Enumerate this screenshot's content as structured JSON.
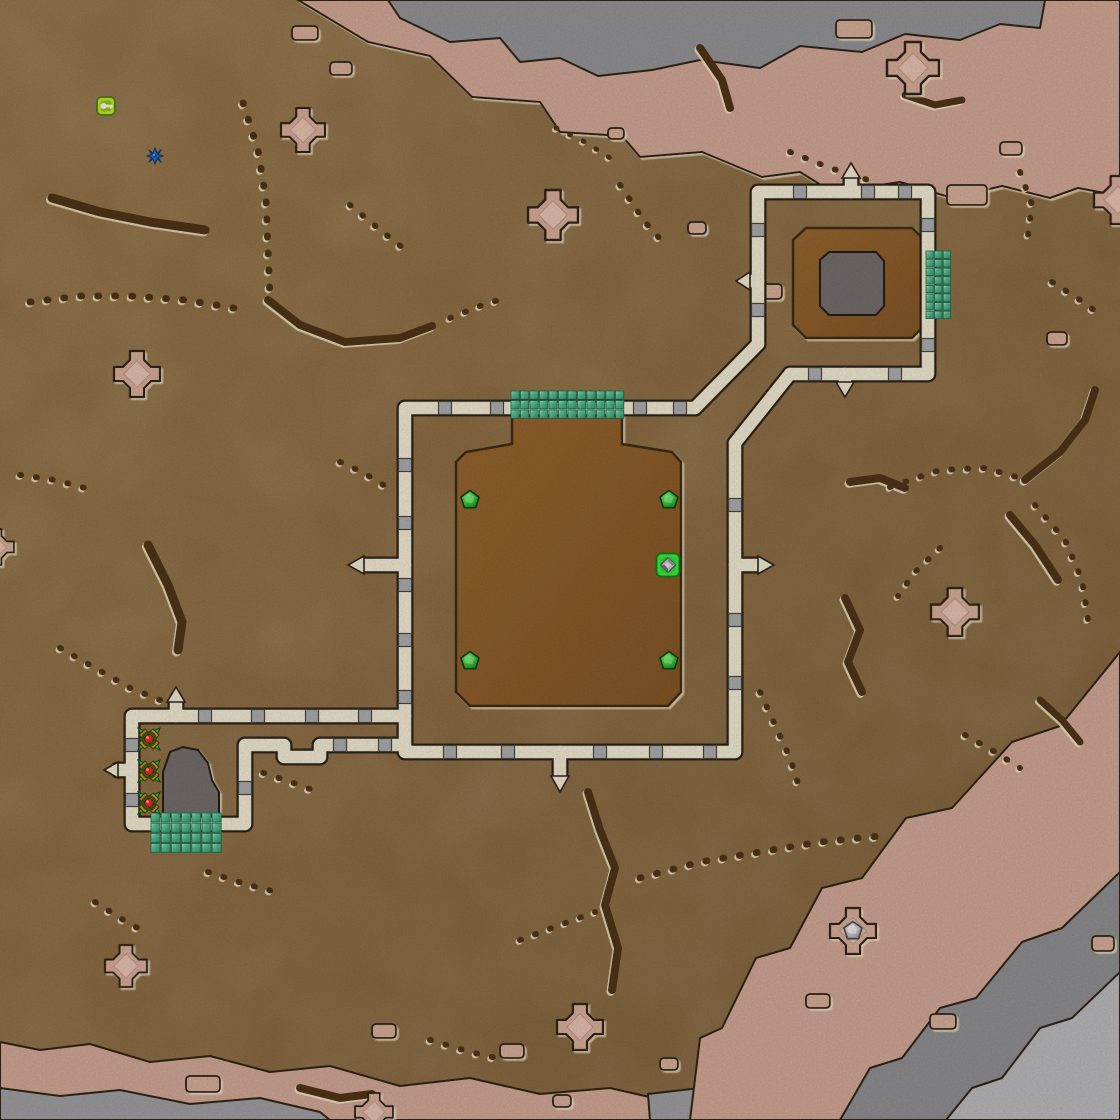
{
  "map": {
    "width": 1120,
    "height": 1120,
    "palette": {
      "terrain": "#8e6d44",
      "terrain_dark": "#7c5f3a",
      "inner_dirt": "#8a5a29",
      "wall": "#e8e1cb",
      "wall_outline": "#2b2215",
      "post_gray": "#a7a7ab",
      "beach_pink": "#cba291",
      "rock_gray": "#8f8f92",
      "rock_gray_light": "#b4b4b6",
      "mound_gray": "#6f6b67",
      "gate_teal": "#4fb78e",
      "marker_green": "#2fb32f",
      "selected_green": "#39e639",
      "crack_brown": "#4e3213",
      "red_dot": "#d32b1f",
      "blue_burst": "#2f72c8",
      "key_icon_green": "#b8e02c"
    },
    "objects": {
      "key_item": {
        "x": 106,
        "y": 106
      },
      "blue_burst": {
        "x": 155,
        "y": 156
      },
      "green_pentagons": [
        [
          470,
          500
        ],
        [
          669,
          500
        ],
        [
          470,
          661
        ],
        [
          669,
          661
        ]
      ],
      "selected_unit": {
        "x": 668,
        "y": 565
      },
      "x_markers": [
        [
          149,
          739
        ],
        [
          149,
          771
        ],
        [
          149,
          803
        ]
      ]
    },
    "gates": [
      {
        "id": "central-top-gate",
        "x": 511,
        "y": 391,
        "cols": 12,
        "rows": 3,
        "s": 9.5
      },
      {
        "id": "outpost-right-gate",
        "x": 926,
        "y": 251,
        "cols": 3,
        "rows": 8,
        "s": 8.6
      },
      {
        "id": "pen-bottom-gate",
        "x": 151,
        "y": 813,
        "cols": 7,
        "rows": 4,
        "s": 10.2
      }
    ],
    "crosses": [
      {
        "cx": 303,
        "cy": 130,
        "s": 44
      },
      {
        "cx": 553,
        "cy": 215,
        "s": 50
      },
      {
        "cx": 913,
        "cy": 68,
        "s": 52
      },
      {
        "cx": 1118,
        "cy": 200,
        "s": 48
      },
      {
        "cx": 137,
        "cy": 374,
        "s": 46
      },
      {
        "cx": 955,
        "cy": 612,
        "s": 48
      },
      {
        "cx": -4,
        "cy": 547,
        "s": 36
      },
      {
        "cx": 126,
        "cy": 966,
        "s": 42
      },
      {
        "cx": 580,
        "cy": 1027,
        "s": 46
      },
      {
        "cx": 374,
        "cy": 1112,
        "s": 38
      },
      {
        "cx": 853,
        "cy": 931,
        "s": 46,
        "pentagon": true
      }
    ],
    "pink_decals": [
      [
        292,
        26,
        26,
        14
      ],
      [
        330,
        62,
        22,
        13
      ],
      [
        836,
        20,
        36,
        18
      ],
      [
        947,
        185,
        40,
        20
      ],
      [
        1000,
        142,
        22,
        13
      ],
      [
        760,
        284,
        22,
        15
      ],
      [
        1047,
        332,
        20,
        13
      ],
      [
        688,
        222,
        18,
        12
      ],
      [
        608,
        128,
        16,
        11
      ],
      [
        186,
        1076,
        34,
        16
      ],
      [
        372,
        1024,
        24,
        14
      ],
      [
        500,
        1044,
        24,
        14
      ],
      [
        930,
        1014,
        26,
        15
      ],
      [
        806,
        994,
        24,
        14
      ],
      [
        1092,
        936,
        22,
        15
      ],
      [
        553,
        1095,
        18,
        12
      ],
      [
        660,
        1058,
        18,
        12
      ]
    ],
    "posts": [
      [
        445,
        408
      ],
      [
        497,
        408
      ],
      [
        640,
        408
      ],
      [
        680,
        408
      ],
      [
        405,
        465
      ],
      [
        405,
        523
      ],
      [
        405,
        585
      ],
      [
        405,
        640
      ],
      [
        405,
        697
      ],
      [
        450,
        752
      ],
      [
        508,
        752
      ],
      [
        600,
        752
      ],
      [
        656,
        752
      ],
      [
        710,
        752
      ],
      [
        735,
        505
      ],
      [
        735,
        620
      ],
      [
        735,
        683
      ],
      [
        205,
        716
      ],
      [
        258,
        716
      ],
      [
        312,
        716
      ],
      [
        365,
        716
      ],
      [
        340,
        745
      ],
      [
        385,
        745
      ],
      [
        132,
        745
      ],
      [
        132,
        800
      ],
      [
        245,
        788
      ],
      [
        800,
        192
      ],
      [
        868,
        192
      ],
      [
        905,
        192
      ],
      [
        758,
        230
      ],
      [
        758,
        310
      ],
      [
        928,
        225
      ],
      [
        928,
        345
      ],
      [
        815,
        374
      ],
      [
        895,
        374
      ]
    ],
    "cracks": [
      {
        "t": "dots",
        "w": 7,
        "p": [
          [
            30,
            302
          ],
          [
            80,
            296
          ],
          [
            130,
            296
          ],
          [
            185,
            300
          ],
          [
            245,
            310
          ]
        ]
      },
      {
        "t": "solid",
        "w": 9,
        "p": [
          [
            52,
            198
          ],
          [
            100,
            212
          ],
          [
            150,
            222
          ],
          [
            205,
            230
          ]
        ]
      },
      {
        "t": "dots",
        "w": 7,
        "p": [
          [
            243,
            103
          ],
          [
            258,
            150
          ],
          [
            266,
            200
          ],
          [
            268,
            250
          ],
          [
            270,
            298
          ]
        ]
      },
      {
        "t": "solid",
        "w": 8,
        "p": [
          [
            268,
            300
          ],
          [
            300,
            325
          ],
          [
            345,
            342
          ],
          [
            400,
            338
          ],
          [
            432,
            326
          ]
        ]
      },
      {
        "t": "dots",
        "w": 6,
        "p": [
          [
            450,
            318
          ],
          [
            480,
            306
          ],
          [
            505,
            298
          ]
        ]
      },
      {
        "t": "dots",
        "w": 6,
        "p": [
          [
            350,
            205
          ],
          [
            380,
            230
          ],
          [
            408,
            252
          ]
        ]
      },
      {
        "t": "solid",
        "w": 9,
        "p": [
          [
            148,
            545
          ],
          [
            168,
            585
          ],
          [
            182,
            622
          ],
          [
            178,
            650
          ]
        ]
      },
      {
        "t": "dots",
        "w": 6,
        "p": [
          [
            60,
            648
          ],
          [
            95,
            668
          ],
          [
            130,
            688
          ],
          [
            160,
            700
          ]
        ]
      },
      {
        "t": "dots",
        "w": 6,
        "p": [
          [
            20,
            475
          ],
          [
            55,
            480
          ],
          [
            85,
            488
          ]
        ]
      },
      {
        "t": "dots",
        "w": 6,
        "p": [
          [
            340,
            462
          ],
          [
            362,
            472
          ],
          [
            385,
            486
          ]
        ]
      },
      {
        "t": "solid",
        "w": 8,
        "p": [
          [
            588,
            792
          ],
          [
            600,
            830
          ],
          [
            615,
            868
          ],
          [
            605,
            905
          ],
          [
            618,
            948
          ],
          [
            612,
            990
          ]
        ]
      },
      {
        "t": "dots",
        "w": 6,
        "p": [
          [
            520,
            940
          ],
          [
            560,
            925
          ],
          [
            595,
            912
          ]
        ]
      },
      {
        "t": "dots",
        "w": 7,
        "p": [
          [
            640,
            878
          ],
          [
            700,
            862
          ],
          [
            760,
            852
          ],
          [
            820,
            842
          ],
          [
            880,
            836
          ]
        ]
      },
      {
        "t": "solid",
        "w": 8,
        "p": [
          [
            850,
            482
          ],
          [
            880,
            478
          ],
          [
            905,
            488
          ]
        ]
      },
      {
        "t": "dots",
        "w": 6,
        "p": [
          [
            890,
            487
          ],
          [
            940,
            470
          ],
          [
            985,
            468
          ],
          [
            1020,
            478
          ]
        ]
      },
      {
        "t": "solid",
        "w": 8,
        "p": [
          [
            1025,
            480
          ],
          [
            1060,
            452
          ],
          [
            1085,
            420
          ],
          [
            1095,
            390
          ]
        ]
      },
      {
        "t": "dots",
        "w": 6,
        "p": [
          [
            1035,
            505
          ],
          [
            1065,
            540
          ],
          [
            1082,
            580
          ],
          [
            1088,
            620
          ]
        ]
      },
      {
        "t": "solid",
        "w": 8,
        "p": [
          [
            1010,
            515
          ],
          [
            1035,
            545
          ],
          [
            1058,
            580
          ]
        ]
      },
      {
        "t": "dots",
        "w": 6,
        "p": [
          [
            940,
            548
          ],
          [
            915,
            572
          ],
          [
            898,
            596
          ]
        ]
      },
      {
        "t": "solid",
        "w": 8,
        "p": [
          [
            845,
            598
          ],
          [
            860,
            630
          ],
          [
            848,
            662
          ],
          [
            862,
            692
          ]
        ]
      },
      {
        "t": "dots",
        "w": 6,
        "p": [
          [
            760,
            692
          ],
          [
            775,
            725
          ],
          [
            790,
            758
          ],
          [
            800,
            790
          ]
        ]
      },
      {
        "t": "dots",
        "w": 6,
        "p": [
          [
            620,
            185
          ],
          [
            645,
            222
          ],
          [
            668,
            248
          ]
        ]
      },
      {
        "t": "solid",
        "w": 8,
        "p": [
          [
            700,
            48
          ],
          [
            722,
            80
          ],
          [
            730,
            108
          ]
        ]
      },
      {
        "t": "dots",
        "w": 6,
        "p": [
          [
            790,
            152
          ],
          [
            830,
            168
          ],
          [
            868,
            180
          ]
        ]
      },
      {
        "t": "solid",
        "w": 7,
        "p": [
          [
            905,
            95
          ],
          [
            935,
            105
          ],
          [
            962,
            100
          ]
        ]
      },
      {
        "t": "dots",
        "w": 6,
        "p": [
          [
            1020,
            172
          ],
          [
            1032,
            205
          ],
          [
            1028,
            235
          ]
        ]
      },
      {
        "t": "dots",
        "w": 6,
        "p": [
          [
            1052,
            282
          ],
          [
            1080,
            300
          ],
          [
            1102,
            316
          ]
        ]
      },
      {
        "t": "dots",
        "w": 6,
        "p": [
          [
            248,
            768
          ],
          [
            285,
            780
          ],
          [
            318,
            792
          ]
        ]
      },
      {
        "t": "dots",
        "w": 6,
        "p": [
          [
            95,
            902
          ],
          [
            120,
            918
          ],
          [
            148,
            934
          ]
        ]
      },
      {
        "t": "dots",
        "w": 6,
        "p": [
          [
            208,
            872
          ],
          [
            245,
            884
          ],
          [
            280,
            893
          ]
        ]
      },
      {
        "t": "solid",
        "w": 8,
        "p": [
          [
            300,
            1088
          ],
          [
            340,
            1098
          ],
          [
            372,
            1094
          ]
        ]
      },
      {
        "t": "dots",
        "w": 6,
        "p": [
          [
            430,
            1040
          ],
          [
            470,
            1052
          ],
          [
            505,
            1060
          ]
        ]
      },
      {
        "t": "dots",
        "w": 6,
        "p": [
          [
            965,
            735
          ],
          [
            995,
            752
          ],
          [
            1020,
            768
          ]
        ]
      },
      {
        "t": "solid",
        "w": 7,
        "p": [
          [
            1040,
            700
          ],
          [
            1062,
            720
          ],
          [
            1080,
            742
          ]
        ]
      },
      {
        "t": "dots",
        "w": 5,
        "p": [
          [
            556,
            128
          ],
          [
            585,
            142
          ],
          [
            610,
            158
          ]
        ]
      }
    ]
  }
}
